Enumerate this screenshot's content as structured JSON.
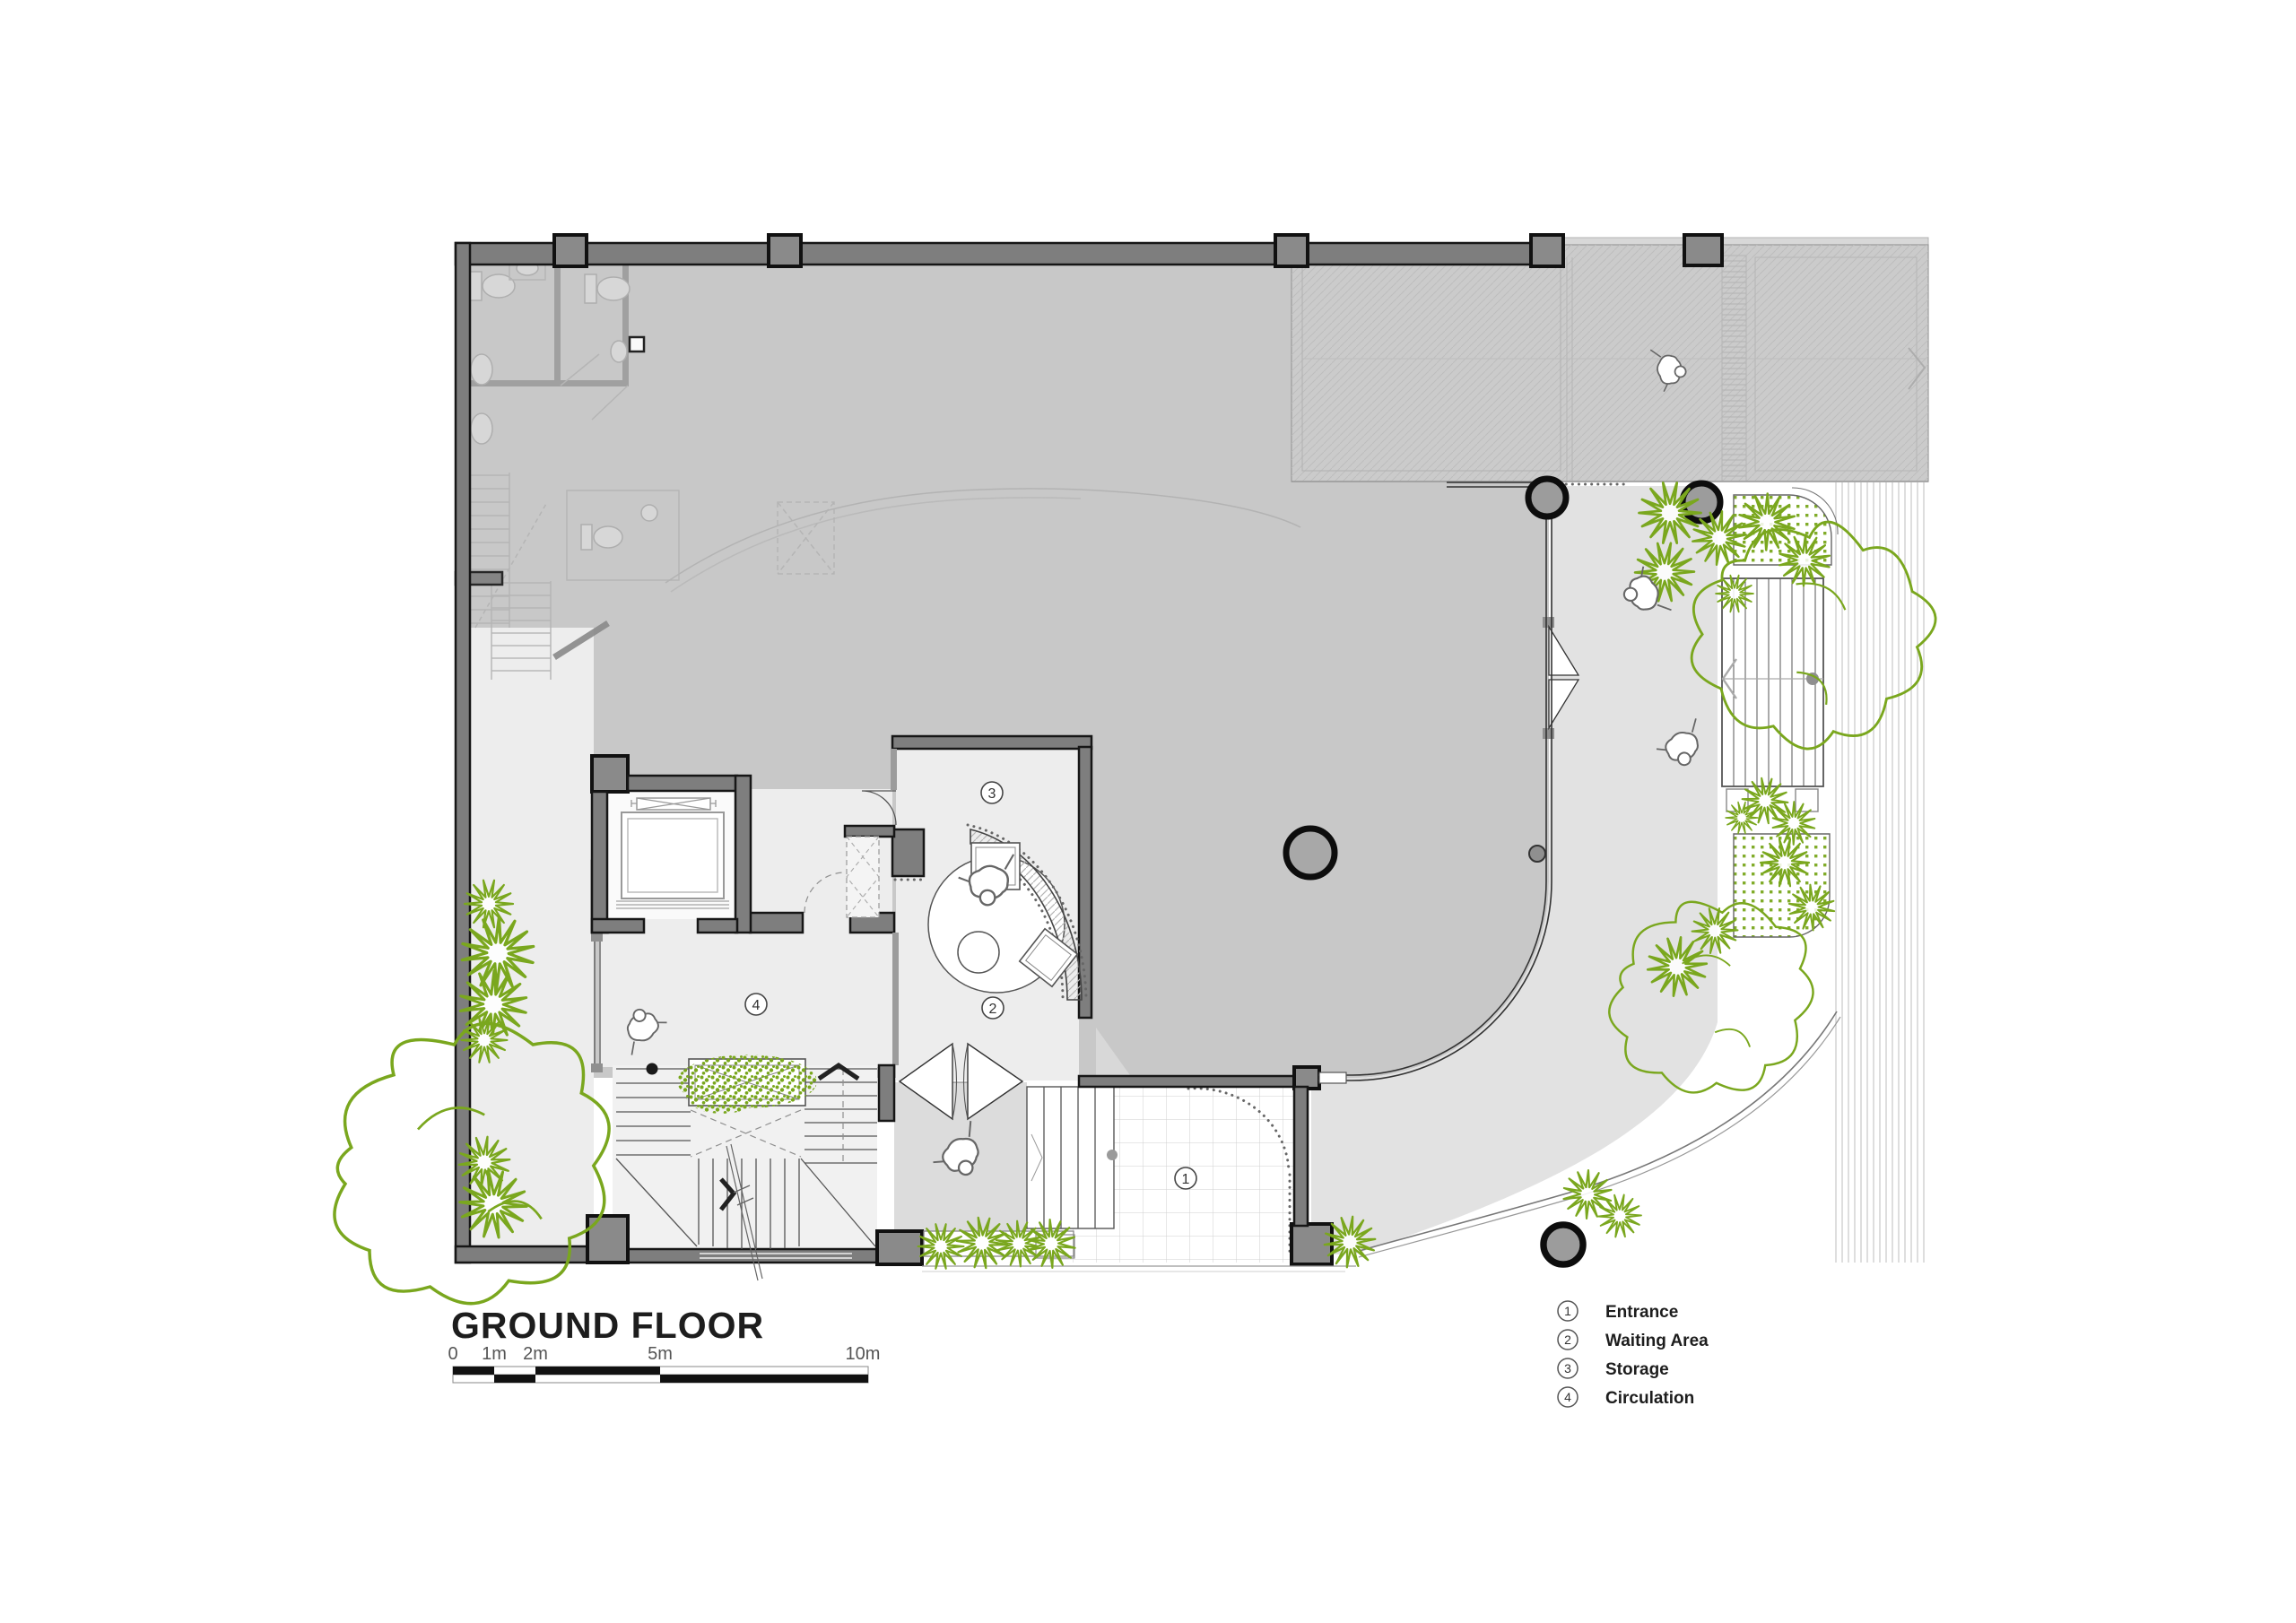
{
  "title": "GROUND FLOOR",
  "scale_bar": {
    "ticks": [
      "0",
      "1m",
      "2m",
      "5m",
      "10m"
    ]
  },
  "legend": {
    "items": [
      {
        "num": "1",
        "label": "Entrance"
      },
      {
        "num": "2",
        "label": "Waiting Area"
      },
      {
        "num": "3",
        "label": "Storage"
      },
      {
        "num": "4",
        "label": "Circulation"
      }
    ]
  },
  "markers": {
    "entrance": "1",
    "waiting": "2",
    "storage": "3",
    "circulation": "4"
  },
  "colors": {
    "plant_green": "#7aa71e",
    "existing_gray": "#c8c8c8",
    "terrace_gray": "#e2e2e2",
    "room_gray": "#ededed",
    "wall_gray": "#7e7e7e",
    "line_black": "#161616"
  }
}
